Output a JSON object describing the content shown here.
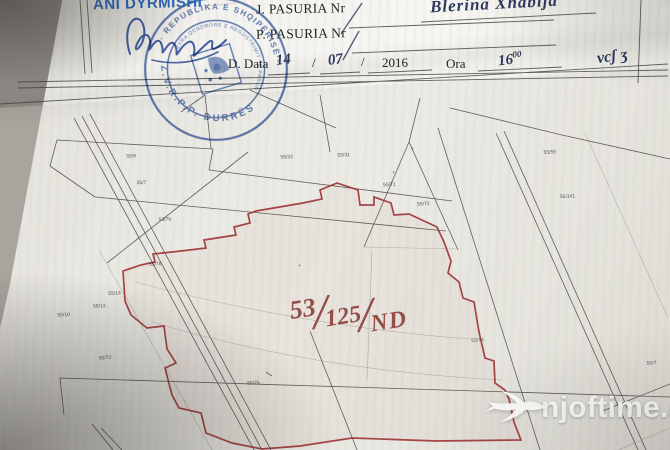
{
  "header": {
    "name": "ANI DYRMISHI",
    "field_j_label": "J. PASURIA  Nr",
    "field_p_label": "P. PASURIA  Nr",
    "handwritten_name": "Blerina  Xhabija",
    "date_label": "D. Data",
    "date_day": "14",
    "date_month": "07",
    "date_year": "2016",
    "date_sep": "/",
    "time_label": "Ora",
    "time_value": "16",
    "time_sup": "00",
    "corner_note": "vcʃ ʒ",
    "ink_color": "#2e3a5f",
    "name_color": "#2a66b8"
  },
  "stamp": {
    "outer_text": "· REPUBLIKA E SHQIPËRISË ·",
    "office_text": "Z.V.R.P.P.  DURRËS",
    "inner_text": "ZYRA QENDRORE E REGJISTRIMIT TË PASURIVE TË PALUAJTSHME",
    "color": "#3c5fa9"
  },
  "map": {
    "boundary_color": "#9c3434",
    "line_color": "#3f3c38",
    "annotation": {
      "part1": "53",
      "separator": "/",
      "part2": "125",
      "part3": "ND",
      "color": "#8b3a34"
    },
    "parcel_labels": [
      {
        "text": "55/9",
        "x": 133,
        "y": 147
      },
      {
        "text": "55/7",
        "x": 142,
        "y": 174
      },
      {
        "text": "53/79",
        "x": 162,
        "y": 212
      },
      {
        "text": "55/78",
        "x": 150,
        "y": 256
      },
      {
        "text": "55/32",
        "x": 287,
        "y": 156
      },
      {
        "text": "55/31",
        "x": 344,
        "y": 157
      },
      {
        "text": "55/71",
        "x": 388,
        "y": 189
      },
      {
        "text": "55/72",
        "x": 421,
        "y": 210
      },
      {
        "text": "55/55",
        "x": 550,
        "y": 165
      },
      {
        "text": "55/141",
        "x": 564,
        "y": 210
      },
      {
        "text": "55/14",
        "x": 108,
        "y": 283
      },
      {
        "text": "55/13",
        "x": 92,
        "y": 295
      },
      {
        "text": "55/10",
        "x": 56,
        "y": 302
      },
      {
        "text": "55/73",
        "x": 95,
        "y": 347
      },
      {
        "text": "55/76",
        "x": 242,
        "y": 380
      },
      {
        "text": "55/74",
        "x": 468,
        "y": 349
      },
      {
        "text": "55/7",
        "x": 642,
        "y": 381
      },
      {
        "text": "+",
        "x": 398,
        "y": 177
      },
      {
        "text": "+",
        "x": 418,
        "y": 154
      },
      {
        "text": "+",
        "x": 299,
        "y": 265
      }
    ]
  },
  "watermark": {
    "text": "njoftime.al",
    "icon": "swallow-icon"
  }
}
